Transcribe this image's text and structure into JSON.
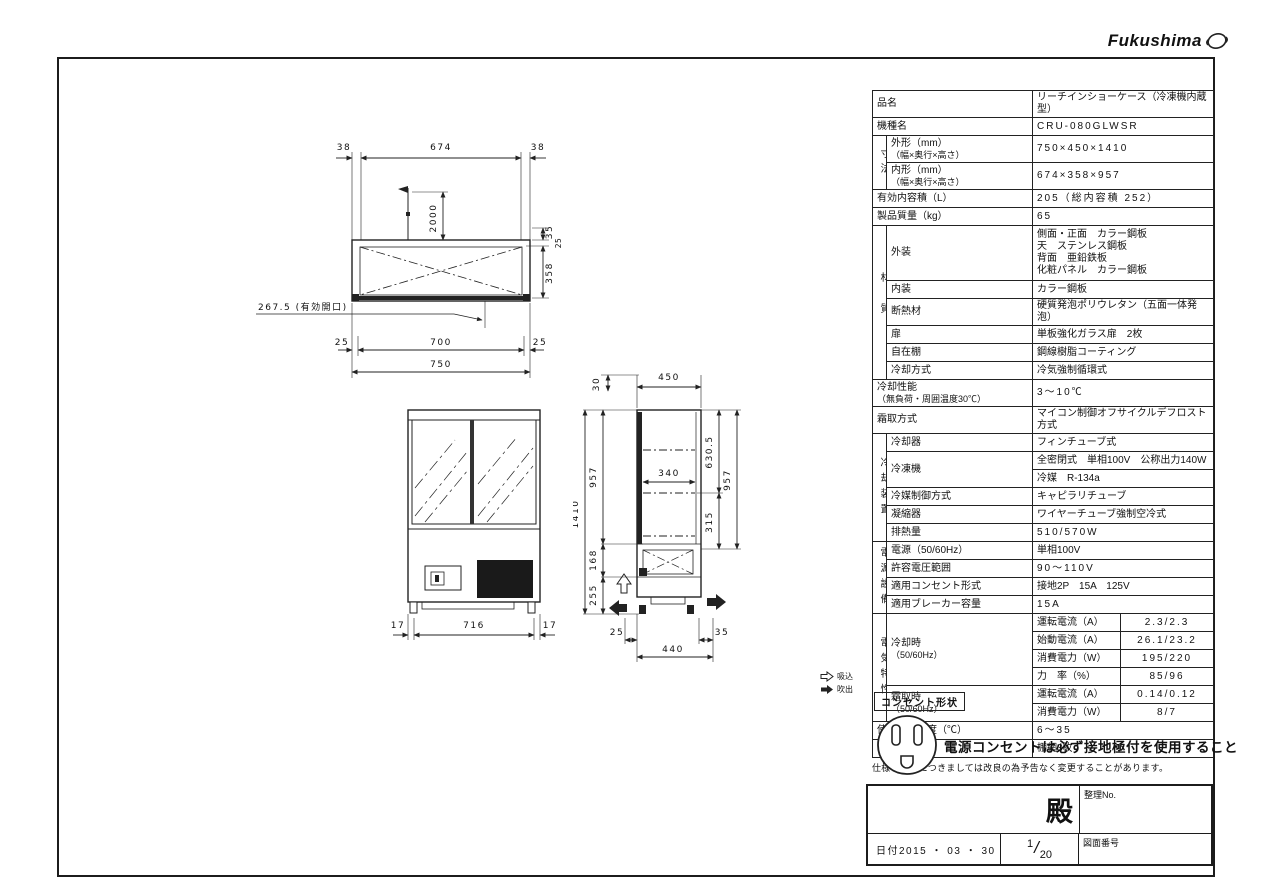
{
  "logo": {
    "brand": "Fukushima"
  },
  "spec_table": {
    "hinmei_label": "品名",
    "hinmei_value": "リーチインショーケース（冷凍機内蔵型）",
    "kishu_label": "機種名",
    "kishu_value": "CRU-080GLWSR",
    "sunpo_group": "寸法",
    "gaikei_label": "外形（mm）",
    "gaikei_sub": "（幅×奥行×高さ）",
    "gaikei_value": "750×450×1410",
    "naikei_label": "内形（mm）",
    "naikei_sub": "（幅×奥行×高さ）",
    "naikei_value": "674×358×957",
    "yuko_label": "有効内容積（L）",
    "yuko_value": "205（総内容積 252）",
    "shitsuryo_label": "製品質量（kg）",
    "shitsuryo_value": "65",
    "zaishitsu_group": "材質",
    "gaiso_label": "外装",
    "gaiso_lines": [
      "側面・正面　カラー鋼板",
      "天　ステンレス鋼板",
      "背面　亜鉛鉄板",
      "化粧パネル　カラー鋼板"
    ],
    "naiso_label": "内装",
    "naiso_value": "カラー鋼板",
    "dannetsu_label": "断熱材",
    "dannetsu_value": "硬質発泡ポリウレタン（五面一体発泡）",
    "tobira_label": "扉",
    "tobira_value": "単板強化ガラス扉　2枚",
    "jizaidana_label": "自在棚",
    "jizaidana_value": "鋼線樹脂コーティング",
    "reikyaku_hoshiki_label": "冷却方式",
    "reikyaku_hoshiki_value": "冷気強制循環式",
    "seino_label": "冷却性能",
    "seino_sub": "（無負荷・周囲温度30℃）",
    "seino_value": "3～10℃",
    "shimotori_label": "霜取方式",
    "shimotori_value": "マイコン制御オフサイクルデフロスト方式",
    "reikyaku_group": "冷却装置",
    "reikyakuki_label": "冷却器",
    "reikyakuki_value": "フィンチューブ式",
    "reitoki_label": "冷凍機",
    "reitoki_value1": "全密閉式　単相100V　公称出力140W",
    "reitoki_value2": "冷媒　R-134a",
    "reibai_label": "冷媒制御方式",
    "reibai_value": "キャピラリチューブ",
    "gyoshukuki_label": "凝縮器",
    "gyoshukuki_value": "ワイヤーチューブ強制空冷式",
    "hainetsu_label": "排熱量",
    "hainetsu_value": "510/570W",
    "dengen_group": "電源設備",
    "dengen_label": "電源（50/60Hz）",
    "dengen_value": "単相100V",
    "kyoyo_label": "許容電圧範囲",
    "kyoyo_value": "90～110V",
    "consento_label": "適用コンセント形式",
    "consento_value": "接地2P　15A　125V",
    "breaker_label": "適用ブレーカー容量",
    "breaker_value": "15A",
    "denki_group": "電気特性",
    "reikyakuji_label": "冷却時",
    "reikyakuji_sub": "（50/60Hz）",
    "unten1_label": "運転電流（A）",
    "unten1_value": "2.3/2.3",
    "shido_label": "始動電流（A）",
    "shido_value": "26.1/23.2",
    "shohi1_label": "消費電力（W）",
    "shohi1_value": "195/220",
    "rikiritsu_label": "力　率（%）",
    "rikiritsu_value": "85/96",
    "shimotoriji_label": "霜取時",
    "shimotoriji_sub": "（50/60Hz）",
    "unten2_label": "運転電流（A）",
    "unten2_value": "0.14/0.12",
    "shohi2_label": "消費電力（W）",
    "shohi2_value": "8/7",
    "shiyo_label": "使用周囲温度（℃）",
    "shiyo_value": "6～35",
    "fuzoku_label": "付属品",
    "fuzoku_value": "棚網3枚"
  },
  "footnote": "仕様・外観につきましては改良の為予告なく変更することがあります。",
  "legend": {
    "intake": "吸込",
    "discharge": "吹出"
  },
  "outlet": {
    "label": "コンセント形状",
    "warning": "電源コンセントは必ず接地極付を使用すること"
  },
  "title_block": {
    "addressee": "殿",
    "control_no_label": "整理No.",
    "date": "日付2015 ・ 03 ・ 30",
    "page_num": "1",
    "page_total": "20",
    "drawing_no_label": "図面番号"
  },
  "drawings": {
    "plan": {
      "d38l": "38",
      "d674": "674",
      "d38r": "38",
      "d2000": "2000",
      "d35": "35",
      "d25s": "25",
      "d358": "358",
      "effective_opening": "267.5 (有効開口)",
      "d25l": "25",
      "d700": "700",
      "d25r": "25",
      "d750": "750"
    },
    "front": {
      "d17l": "17",
      "d716": "716",
      "d17r": "17"
    },
    "side": {
      "d30": "30",
      "d450": "450",
      "d1410": "1410",
      "d957l": "957",
      "d168": "168",
      "d255": "255",
      "d340": "340",
      "d630": "630.5",
      "d957r": "957",
      "d315": "315",
      "d25": "25",
      "d440": "440",
      "d35": "35"
    }
  }
}
